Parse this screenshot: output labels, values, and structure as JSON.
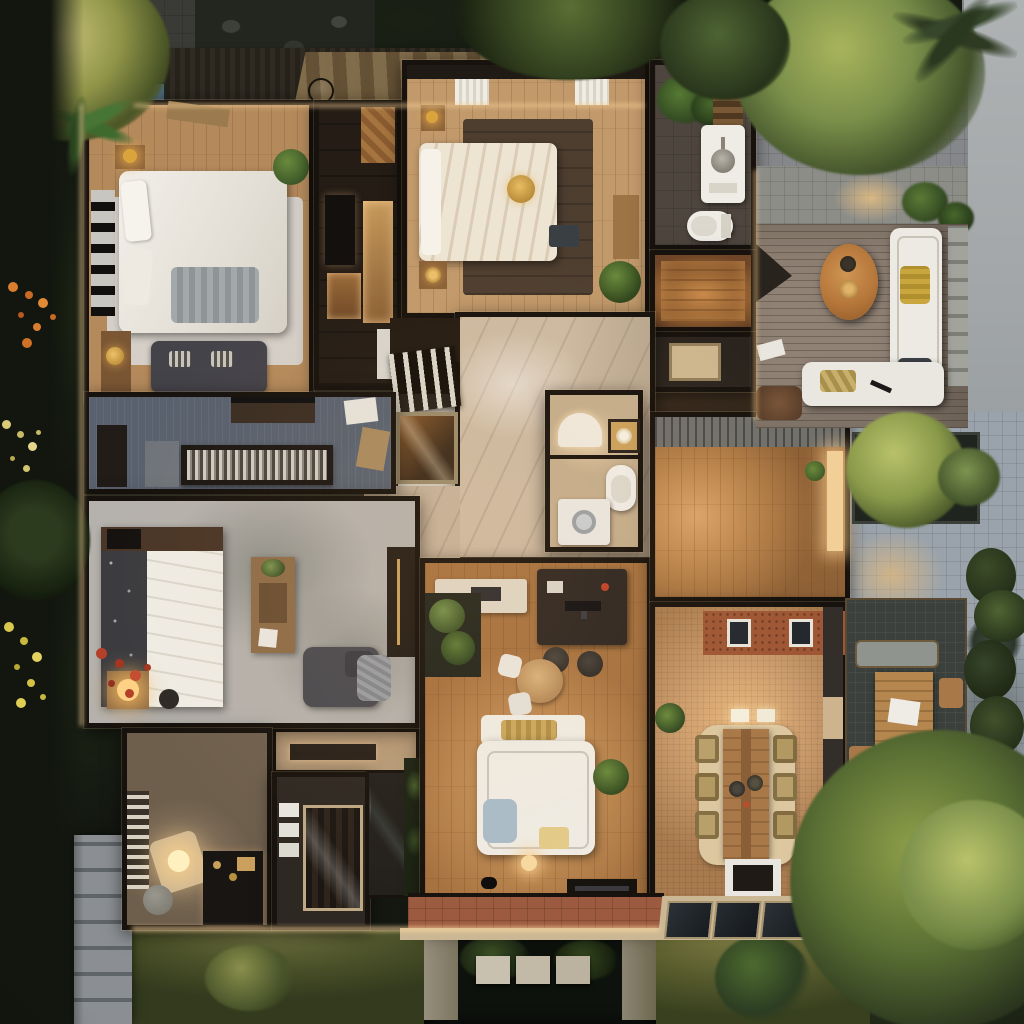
{
  "scene": {
    "title": "Photorealistic aerial floor-plan render of a modern single-story house at dusk, surrounded by tropical garden",
    "time_of_day": "dusk",
    "view": "top-down"
  },
  "palette": {
    "garden_dark": "#161a12",
    "foliage_green": "#4e6a30",
    "foliage_yellow_green": "#b9c26a",
    "wood_floor": "#b9854f",
    "dark_wood": "#241c15",
    "marble": "#cdbaa2",
    "deck_gray_wood": "#8f8174",
    "paver_gray": "#9aa3ab",
    "road_gray": "#a6aaab",
    "brick_wall": "#9e5634",
    "terracotta_porch": "#9c5b40",
    "wall_dark": "#17120d",
    "white_furniture": "#efece4",
    "warm_glow": "#ffd9a0",
    "gold_accent": "#d9a43c",
    "water_dark": "#0e120d",
    "library_floor": "#59616e",
    "stone_floor_gray": "#b5b1ac"
  },
  "rooms": [
    {
      "id": "master-bedroom",
      "label": "Master bedroom",
      "items": [
        "white king bed",
        "knit throw",
        "gallery shelf wall",
        "nightstand with gold lamp",
        "gold tray console",
        "dark gray sofa with striped pillows",
        "potted plant"
      ]
    },
    {
      "id": "walk-in-closet",
      "label": "Walk-in closet corridor",
      "items": [
        "backlit wardrobe niches",
        "island cabinet",
        "herringbone entry patch"
      ]
    },
    {
      "id": "bedroom-2",
      "label": "Guest bedroom",
      "items": [
        "cream striped bed",
        "gold round tray",
        "dark area rug",
        "nightstands with gold lamps",
        "wood bench",
        "plant",
        "white towels on rail"
      ]
    },
    {
      "id": "bathroom",
      "label": "Main bathroom",
      "items": [
        "white vanity with round basin",
        "toilet",
        "indoor plants",
        "wood ladder shelf"
      ]
    },
    {
      "id": "sauna",
      "label": "Sauna / warm wood room",
      "items": [
        "glowing wood floor"
      ]
    },
    {
      "id": "shower-room",
      "label": "Shower room",
      "items": [
        "stone shower tray"
      ]
    },
    {
      "id": "foyer",
      "label": "Marble foyer",
      "items": [
        "veined marble floor"
      ]
    },
    {
      "id": "staircase",
      "label": "Staircase with glass balustrade",
      "items": [
        "white balusters",
        "amber glass stair box"
      ]
    },
    {
      "id": "powder-room",
      "label": "Powder room and laundry",
      "items": [
        "arched white niche",
        "gold flower artwork",
        "toilet",
        "washing machine"
      ]
    },
    {
      "id": "library",
      "label": "Library / media wall",
      "items": [
        "long shelf of books and records",
        "speaker cabinet",
        "wall-hung console with soundbar",
        "loose paper"
      ]
    },
    {
      "id": "bedroom-3",
      "label": "Second bedroom",
      "items": [
        "bed with white duvet and patterned throw",
        "glowing bedside lamp",
        "stool",
        "dressing table with mirror",
        "gray armchair with blanket",
        "tall wardrobe"
      ]
    },
    {
      "id": "den",
      "label": "Den / dressing room",
      "items": [
        "louvered screen",
        "glowing floor lamp",
        "gray pouf",
        "dark dresser with gold knobs"
      ]
    },
    {
      "id": "glass-shower",
      "label": "Glass shower box",
      "items": [
        "white towel shelves",
        "glass enclosure"
      ]
    },
    {
      "id": "living-room",
      "label": "Living room and study",
      "items": [
        "study desk with monitor",
        "two desk chairs",
        "round table with white chairs",
        "white sectional sofa",
        "yellow and blue cushions",
        "indoor planter bed",
        "kitchen counter",
        "media console",
        "floor lamp",
        "black cat figure"
      ]
    },
    {
      "id": "great-room",
      "label": "Open family area",
      "items": [
        "warm wood floor",
        "lit doorway to courtyard",
        "potted plant"
      ]
    },
    {
      "id": "dining-room",
      "label": "Dining room",
      "items": [
        "plank dining table for six",
        "wicker chairs",
        "black serving plates",
        "pendant lights",
        "brick wall with two windows",
        "sideboard on white mat",
        "corner plant"
      ]
    },
    {
      "id": "porch",
      "label": "Entry porch",
      "items": [
        "terracotta tiles"
      ]
    }
  ],
  "outdoor": [
    {
      "id": "roof-terrace",
      "label": "Dark slatted terrace walkway along the top of the house"
    },
    {
      "id": "skylight",
      "label": "Blue glass skylight"
    },
    {
      "id": "wire-pendant",
      "label": "Round wire pendant sphere"
    },
    {
      "id": "deck-lounge",
      "label": "Gray wood deck lounge with white L-sofa, oval wood coffee table, doormat and shade wedge"
    },
    {
      "id": "paver-plaza",
      "label": "Blue-gray paver courtyard with tree planter and palm shadows"
    },
    {
      "id": "driveway",
      "label": "Pale concrete side street / driveway"
    },
    {
      "id": "patio-dining",
      "label": "Outdoor dining patio with wood table, bench and chairs on dark tile"
    },
    {
      "id": "pond",
      "label": "Reflecting pond with stepping stones and stone pillars"
    },
    {
      "id": "lawns",
      "label": "Lawns and tropical planting with orange, yellow and red flower accents"
    },
    {
      "id": "stone-path",
      "label": "Stone paver path at lower left"
    },
    {
      "id": "entry-path",
      "label": "Dark paver entry path at upper left"
    },
    {
      "id": "planter-tree",
      "label": "Courtyard tree in dark planter box"
    },
    {
      "id": "hedge",
      "label": "Roadside hedge and palms"
    },
    {
      "id": "porch-skylights",
      "label": "Three angled glass canopy panels over the porch"
    }
  ]
}
